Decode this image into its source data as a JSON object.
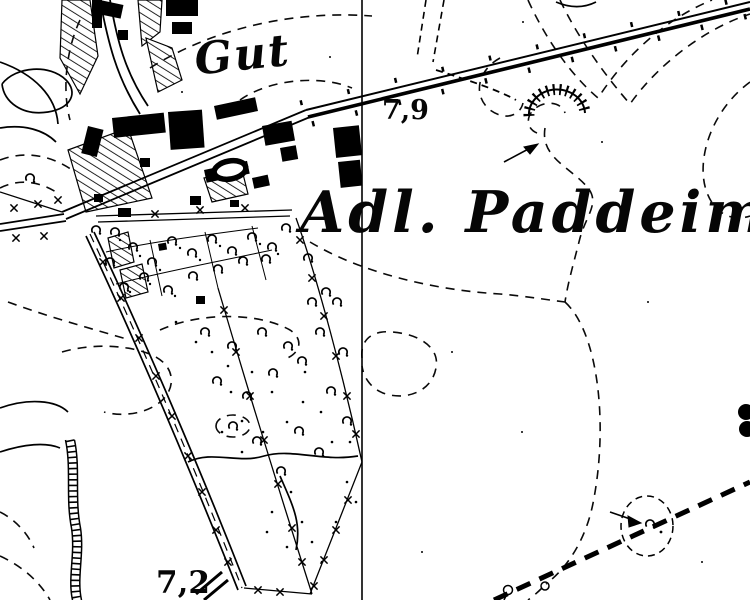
{
  "map": {
    "type": "historical-topographic-map",
    "labels": {
      "estate": "Gut",
      "place_name": "Adl. Paddeim",
      "spot_height_north": "7,9",
      "spot_height_south": "7,2"
    },
    "colors": {
      "ink": "#000000",
      "paper": "#ffffff"
    },
    "symbols": [
      "contour-line-dashed",
      "grid-line-vertical",
      "chaussee-road",
      "tree-lined-road",
      "field-path-dashed",
      "building-block",
      "courtyard-oval",
      "garden-hatching",
      "park-tree",
      "fence-cross",
      "pit-hachures",
      "embankment-ditch",
      "boundary-line-bold-dashed",
      "direction-arrow",
      "lone-tree-in-clearing",
      "spot-elevation"
    ]
  }
}
